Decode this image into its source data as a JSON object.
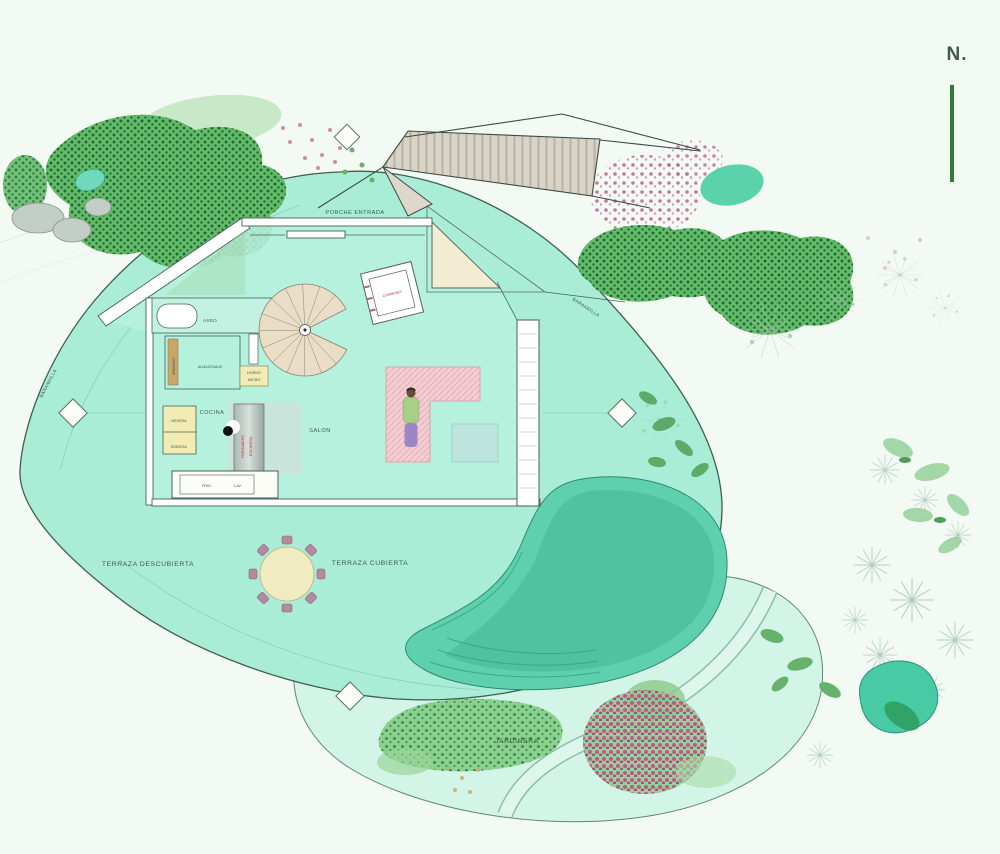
{
  "north": {
    "label": "N."
  },
  "plan": {
    "entrance_label": "PORCHE ENTRADA",
    "rooms": {
      "aseo": "ASEO",
      "cocina": "COCINA",
      "salon": "SALON"
    },
    "kitchen": {
      "almacenaje": "ALMACENAJE",
      "horno": "HORNO",
      "micro": "MICRO",
      "armario": "ARMARIO",
      "nevera": "NEVERA",
      "bodega": "BODEGA",
      "fregadero": "FREGADERO",
      "encimera": "ENCIMERA",
      "frig": "FRIG.",
      "lav": "LAV."
    },
    "fireplace_label": "CHIMENEA"
  },
  "site": {
    "terraza_descubierta": "TERRAZA DESCUBIERTA",
    "terraza_cubierta": "TERRAZA CUBIERTA",
    "jardinera": "JARDINERA",
    "barandilla": "BARANDILLA"
  },
  "colors": {
    "background": "#f3faf3",
    "deck": "#a9edd7",
    "deck_outline": "#3f5e52",
    "pool": "#5fd0ae",
    "pool_deep": "#4cc19e",
    "lower_deck": "#d2f5e7",
    "plan_floor": "#b9f1df",
    "vegetation_green": "#66bb6a",
    "vegetation_dark": "#1b6e33",
    "flower_pink": "#c06898",
    "label": "#3e5a50",
    "label_red": "#c03a3a",
    "north_green": "#2e7d32",
    "furniture_yellow": "#f2ecb4",
    "table_cream": "#f0ecc2",
    "sofa_pink": "#f4cdd3",
    "rug_blue": "#bfe3de"
  }
}
